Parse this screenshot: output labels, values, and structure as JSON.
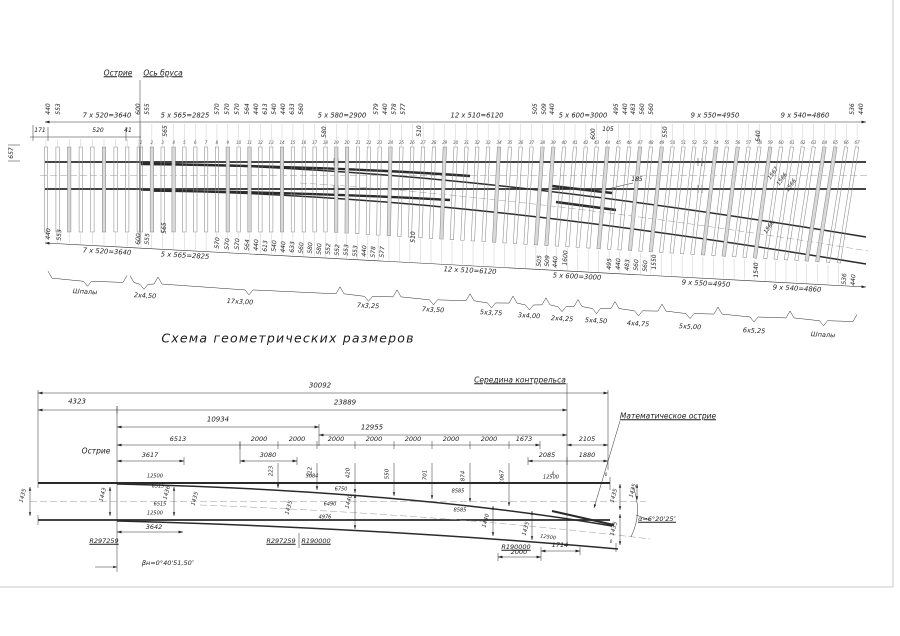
{
  "title": "Схема геометрических размеров",
  "top_diagram": {
    "sleeper_numbers": {
      "from": 1,
      "to": 67
    },
    "labels": [
      {
        "t": "Острие",
        "x": 118,
        "y": 73,
        "s": 7.5,
        "u": 1
      },
      {
        "t": "Ось бруса",
        "x": 163,
        "y": 73,
        "s": 7.5,
        "u": 1
      },
      {
        "t": "657",
        "x": 12,
        "y": 153,
        "r": -90,
        "s": 6
      },
      {
        "t": "440",
        "x": 49,
        "y": 109,
        "r": -90,
        "s": 6
      },
      {
        "t": "553",
        "x": 59,
        "y": 109,
        "r": -90,
        "s": 6
      },
      {
        "t": "600",
        "x": 139,
        "y": 109,
        "r": -90,
        "s": 6
      },
      {
        "t": "555",
        "x": 148,
        "y": 109,
        "r": -90,
        "s": 6
      },
      {
        "t": "570",
        "x": 218,
        "y": 109,
        "r": -90,
        "s": 6
      },
      {
        "t": "570",
        "x": 228,
        "y": 109,
        "r": -90,
        "s": 6
      },
      {
        "t": "570",
        "x": 238,
        "y": 109,
        "r": -90,
        "s": 6
      },
      {
        "t": "564",
        "x": 248,
        "y": 109,
        "r": -90,
        "s": 6
      },
      {
        "t": "440",
        "x": 257,
        "y": 109,
        "r": -90,
        "s": 6
      },
      {
        "t": "613",
        "x": 266,
        "y": 109,
        "r": -90,
        "s": 6
      },
      {
        "t": "540",
        "x": 275,
        "y": 109,
        "r": -90,
        "s": 6
      },
      {
        "t": "440",
        "x": 284,
        "y": 109,
        "r": -90,
        "s": 6
      },
      {
        "t": "633",
        "x": 293,
        "y": 109,
        "r": -90,
        "s": 6
      },
      {
        "t": "560",
        "x": 302,
        "y": 109,
        "r": -90,
        "s": 6
      },
      {
        "t": "579",
        "x": 377,
        "y": 109,
        "r": -90,
        "s": 6
      },
      {
        "t": "440",
        "x": 386,
        "y": 109,
        "r": -90,
        "s": 6
      },
      {
        "t": "578",
        "x": 395,
        "y": 109,
        "r": -90,
        "s": 6
      },
      {
        "t": "577",
        "x": 404,
        "y": 109,
        "r": -90,
        "s": 6
      },
      {
        "t": "505",
        "x": 536,
        "y": 109,
        "r": -90,
        "s": 6
      },
      {
        "t": "509",
        "x": 545,
        "y": 109,
        "r": -90,
        "s": 6
      },
      {
        "t": "440",
        "x": 553,
        "y": 109,
        "r": -90,
        "s": 6
      },
      {
        "t": "495",
        "x": 617,
        "y": 109,
        "r": -90,
        "s": 6
      },
      {
        "t": "440",
        "x": 626,
        "y": 109,
        "r": -90,
        "s": 6
      },
      {
        "t": "483",
        "x": 634,
        "y": 109,
        "r": -90,
        "s": 6
      },
      {
        "t": "560",
        "x": 643,
        "y": 109,
        "r": -90,
        "s": 6
      },
      {
        "t": "560",
        "x": 652,
        "y": 109,
        "r": -90,
        "s": 6
      },
      {
        "t": "536",
        "x": 853,
        "y": 109,
        "r": -90,
        "s": 6
      },
      {
        "t": "440",
        "x": 862,
        "y": 109,
        "r": -90,
        "s": 6
      },
      {
        "t": "7 x 520=3640",
        "x": 107,
        "y": 116,
        "s": 6.8
      },
      {
        "t": "5 x 565=2825",
        "x": 185,
        "y": 116,
        "s": 6.8
      },
      {
        "t": "5 x 580=2900",
        "x": 342,
        "y": 116,
        "s": 6.8
      },
      {
        "t": "12 x 510=6120",
        "x": 477,
        "y": 116,
        "s": 6.8
      },
      {
        "t": "5 x 600=3000",
        "x": 583,
        "y": 116,
        "s": 6.8
      },
      {
        "t": "9 x 550=4950",
        "x": 715,
        "y": 116,
        "s": 6.8
      },
      {
        "t": "9 x 540=4860",
        "x": 805,
        "y": 116,
        "s": 6.8
      },
      {
        "t": "171",
        "x": 40,
        "y": 131,
        "s": 6
      },
      {
        "t": "520",
        "x": 98,
        "y": 131,
        "s": 6
      },
      {
        "t": "41",
        "x": 128,
        "y": 131,
        "s": 6
      },
      {
        "t": "565",
        "x": 166,
        "y": 131,
        "r": -90,
        "s": 6
      },
      {
        "t": "580",
        "x": 325,
        "y": 132,
        "r": -90,
        "s": 6
      },
      {
        "t": "510",
        "x": 420,
        "y": 131,
        "r": -90,
        "s": 6
      },
      {
        "t": "600",
        "x": 594,
        "y": 134,
        "r": -90,
        "s": 6
      },
      {
        "t": "105",
        "x": 608,
        "y": 130,
        "s": 6
      },
      {
        "t": "550",
        "x": 666,
        "y": 132,
        "r": -90,
        "s": 6
      },
      {
        "t": "540",
        "x": 759,
        "y": 136,
        "r": -90,
        "s": 6
      },
      {
        "t": "185",
        "x": 637,
        "y": 180,
        "s": 6
      },
      {
        "t": "1567",
        "x": 774,
        "y": 174,
        "r": -55,
        "s": 5.5
      },
      {
        "t": "1566",
        "x": 783,
        "y": 180,
        "r": -55,
        "s": 5.5
      },
      {
        "t": "1566",
        "x": 792,
        "y": 186,
        "r": -55,
        "s": 5.5
      },
      {
        "t": "1566",
        "x": 770,
        "y": 228,
        "r": -55,
        "s": 5.5
      },
      {
        "t": "440",
        "x": 49,
        "y": 234,
        "r": -87,
        "s": 6
      },
      {
        "t": "553",
        "x": 60,
        "y": 235,
        "r": -87,
        "s": 6
      },
      {
        "t": "600",
        "x": 139,
        "y": 239,
        "r": -87,
        "s": 6
      },
      {
        "t": "555",
        "x": 148,
        "y": 239,
        "r": -87,
        "s": 6
      },
      {
        "t": "565",
        "x": 165,
        "y": 228,
        "r": -90,
        "s": 6
      },
      {
        "t": "570",
        "x": 218,
        "y": 243,
        "r": -87,
        "s": 6
      },
      {
        "t": "570",
        "x": 228,
        "y": 244,
        "r": -87,
        "s": 6
      },
      {
        "t": "570",
        "x": 238,
        "y": 244,
        "r": -87,
        "s": 6
      },
      {
        "t": "564",
        "x": 248,
        "y": 245,
        "r": -87,
        "s": 6
      },
      {
        "t": "440",
        "x": 257,
        "y": 245,
        "r": -87,
        "s": 6
      },
      {
        "t": "613",
        "x": 266,
        "y": 246,
        "r": -87,
        "s": 6
      },
      {
        "t": "540",
        "x": 275,
        "y": 246,
        "r": -87,
        "s": 6
      },
      {
        "t": "440",
        "x": 284,
        "y": 247,
        "r": -87,
        "s": 6
      },
      {
        "t": "633",
        "x": 293,
        "y": 247,
        "r": -87,
        "s": 6
      },
      {
        "t": "560",
        "x": 302,
        "y": 248,
        "r": -87,
        "s": 6
      },
      {
        "t": "580",
        "x": 311,
        "y": 248,
        "r": -87,
        "s": 6
      },
      {
        "t": "580",
        "x": 320,
        "y": 249,
        "r": -87,
        "s": 6
      },
      {
        "t": "552",
        "x": 329,
        "y": 249,
        "r": -87,
        "s": 6
      },
      {
        "t": "552",
        "x": 338,
        "y": 250,
        "r": -87,
        "s": 6
      },
      {
        "t": "553",
        "x": 347,
        "y": 250,
        "r": -87,
        "s": 6
      },
      {
        "t": "553",
        "x": 356,
        "y": 251,
        "r": -87,
        "s": 6
      },
      {
        "t": "440",
        "x": 365,
        "y": 251,
        "r": -87,
        "s": 6
      },
      {
        "t": "578",
        "x": 374,
        "y": 252,
        "r": -87,
        "s": 6
      },
      {
        "t": "577",
        "x": 383,
        "y": 252,
        "r": -87,
        "s": 6
      },
      {
        "t": "510",
        "x": 414,
        "y": 237,
        "r": -90,
        "s": 6
      },
      {
        "t": "505",
        "x": 540,
        "y": 261,
        "r": -87,
        "s": 6
      },
      {
        "t": "509",
        "x": 548,
        "y": 261,
        "r": -87,
        "s": 6
      },
      {
        "t": "440",
        "x": 556,
        "y": 262,
        "r": -87,
        "s": 6
      },
      {
        "t": "1600",
        "x": 566,
        "y": 258,
        "r": -87,
        "s": 6
      },
      {
        "t": "495",
        "x": 610,
        "y": 264,
        "r": -87,
        "s": 6
      },
      {
        "t": "440",
        "x": 619,
        "y": 264,
        "r": -87,
        "s": 6
      },
      {
        "t": "483",
        "x": 628,
        "y": 265,
        "r": -87,
        "s": 6
      },
      {
        "t": "560",
        "x": 637,
        "y": 265,
        "r": -87,
        "s": 6
      },
      {
        "t": "560",
        "x": 646,
        "y": 266,
        "r": -87,
        "s": 6
      },
      {
        "t": "1550",
        "x": 655,
        "y": 262,
        "r": -90,
        "s": 6
      },
      {
        "t": "1540",
        "x": 757,
        "y": 270,
        "r": -90,
        "s": 6
      },
      {
        "t": "536",
        "x": 845,
        "y": 279,
        "r": -87,
        "s": 6
      },
      {
        "t": "440",
        "x": 854,
        "y": 280,
        "r": -87,
        "s": 6
      },
      {
        "t": "7 x 520=3640",
        "x": 107,
        "y": 252,
        "r": 3,
        "s": 6.8
      },
      {
        "t": "5 x 565=2825",
        "x": 185,
        "y": 256,
        "r": 3,
        "s": 6.8
      },
      {
        "t": "12 x 510=6120",
        "x": 470,
        "y": 271,
        "r": 3,
        "s": 6.8
      },
      {
        "t": "5 x 600=3000",
        "x": 577,
        "y": 277,
        "r": 3,
        "s": 6.8
      },
      {
        "t": "9 x 550=4950",
        "x": 706,
        "y": 284,
        "r": 3,
        "s": 6.8
      },
      {
        "t": "9 x 540=4860",
        "x": 797,
        "y": 289,
        "r": 3,
        "s": 6.8
      }
    ],
    "braces": [
      {
        "t": "Шпалы",
        "x1": 48,
        "x2": 127,
        "lx": 85,
        "ly": 292
      },
      {
        "t": "2x4,50",
        "x1": 130,
        "x2": 158,
        "lx": 145,
        "ly": 296
      },
      {
        "t": "17x3,00",
        "x1": 158,
        "x2": 340,
        "lx": 240,
        "ly": 302
      },
      {
        "t": "7x3,25",
        "x1": 340,
        "x2": 397,
        "lx": 368,
        "ly": 306
      },
      {
        "t": "7x3,50",
        "x1": 397,
        "x2": 470,
        "lx": 433,
        "ly": 310
      },
      {
        "t": "5x3,75",
        "x1": 470,
        "x2": 513,
        "lx": 491,
        "ly": 313
      },
      {
        "t": "3x4,00",
        "x1": 513,
        "x2": 546,
        "lx": 529,
        "ly": 316
      },
      {
        "t": "2x4,25",
        "x1": 546,
        "x2": 578,
        "lx": 562,
        "ly": 319
      },
      {
        "t": "5x4,50",
        "x1": 578,
        "x2": 615,
        "lx": 596,
        "ly": 321
      },
      {
        "t": "4x4,75",
        "x1": 615,
        "x2": 662,
        "lx": 638,
        "ly": 324
      },
      {
        "t": "5x5,00",
        "x1": 662,
        "x2": 718,
        "lx": 690,
        "ly": 327
      },
      {
        "t": "6x5,25",
        "x1": 718,
        "x2": 790,
        "lx": 754,
        "ly": 331
      },
      {
        "t": "Шпалы",
        "x1": 790,
        "x2": 857,
        "lx": 823,
        "ly": 335
      }
    ]
  },
  "bottom_diagram": {
    "labels": [
      {
        "t": "Середина контррельса",
        "x": 520,
        "y": 380,
        "s": 7.5,
        "u": 1
      },
      {
        "t": "Математическое острие",
        "x": 668,
        "y": 416,
        "s": 7.5,
        "u": 1
      },
      {
        "t": "Острие",
        "x": 96,
        "y": 451,
        "s": 7.5
      },
      {
        "t": "30092",
        "x": 320,
        "y": 386,
        "s": 7
      },
      {
        "t": "4323",
        "x": 77,
        "y": 402,
        "s": 7
      },
      {
        "t": "23889",
        "x": 345,
        "y": 403,
        "s": 7
      },
      {
        "t": "10934",
        "x": 218,
        "y": 420,
        "s": 7
      },
      {
        "t": "12955",
        "x": 372,
        "y": 428,
        "s": 7
      },
      {
        "t": "6513",
        "x": 178,
        "y": 439,
        "s": 6.5
      },
      {
        "t": "2000",
        "x": 259,
        "y": 439,
        "s": 6.5
      },
      {
        "t": "2000",
        "x": 297,
        "y": 439,
        "s": 6.5
      },
      {
        "t": "2000",
        "x": 336,
        "y": 439,
        "s": 6.5
      },
      {
        "t": "2000",
        "x": 374,
        "y": 439,
        "s": 6.5
      },
      {
        "t": "2000",
        "x": 413,
        "y": 439,
        "s": 6.5
      },
      {
        "t": "2000",
        "x": 451,
        "y": 439,
        "s": 6.5
      },
      {
        "t": "2000",
        "x": 489,
        "y": 439,
        "s": 6.5
      },
      {
        "t": "1673",
        "x": 524,
        "y": 439,
        "s": 6.5
      },
      {
        "t": "2105",
        "x": 587,
        "y": 439,
        "s": 6.5
      },
      {
        "t": "3617",
        "x": 150,
        "y": 455,
        "s": 6.5
      },
      {
        "t": "3080",
        "x": 268,
        "y": 455,
        "s": 6.5
      },
      {
        "t": "2085",
        "x": 547,
        "y": 455,
        "s": 6.5
      },
      {
        "t": "1880",
        "x": 587,
        "y": 455,
        "s": 6.5
      },
      {
        "t": "223",
        "x": 272,
        "y": 471,
        "r": -90,
        "s": 5.5
      },
      {
        "t": "312",
        "x": 311,
        "y": 472,
        "r": -90,
        "s": 5.5
      },
      {
        "t": "420",
        "x": 349,
        "y": 473,
        "r": -90,
        "s": 5.5
      },
      {
        "t": "550",
        "x": 388,
        "y": 474,
        "r": -90,
        "s": 5.5
      },
      {
        "t": "701",
        "x": 426,
        "y": 475,
        "r": -90,
        "s": 5.5
      },
      {
        "t": "874",
        "x": 464,
        "y": 476,
        "r": -90,
        "s": 5.5
      },
      {
        "t": "1067",
        "x": 503,
        "y": 477,
        "r": -90,
        "s": 5.5
      },
      {
        "t": "12500",
        "x": 155,
        "y": 477,
        "s": 5
      },
      {
        "t": "6515",
        "x": 158,
        "y": 487,
        "s": 5
      },
      {
        "t": "6515",
        "x": 160,
        "y": 505,
        "s": 5
      },
      {
        "t": "12500",
        "x": 155,
        "y": 514,
        "s": 5
      },
      {
        "t": "5084",
        "x": 312,
        "y": 477,
        "s": 5
      },
      {
        "t": "6750",
        "x": 341,
        "y": 490,
        "s": 5
      },
      {
        "t": "6490",
        "x": 330,
        "y": 505,
        "s": 5
      },
      {
        "t": "4976",
        "x": 325,
        "y": 518,
        "s": 5
      },
      {
        "t": "8585",
        "x": 458,
        "y": 492,
        "s": 5
      },
      {
        "t": "8585",
        "x": 460,
        "y": 511,
        "s": 5
      },
      {
        "t": "12500",
        "x": 551,
        "y": 478,
        "s": 5
      },
      {
        "t": "12500",
        "x": 548,
        "y": 538,
        "r": 8,
        "s": 5
      },
      {
        "t": "0",
        "x": 553,
        "y": 474,
        "s": 4
      },
      {
        "t": "0",
        "x": 606,
        "y": 475,
        "s": 4
      },
      {
        "t": "0",
        "x": 611,
        "y": 542,
        "s": 4
      },
      {
        "t": "1435",
        "x": 24,
        "y": 496,
        "r": -75,
        "s": 5.5
      },
      {
        "t": "1443",
        "x": 104,
        "y": 495,
        "r": -75,
        "s": 5.5
      },
      {
        "t": "1436",
        "x": 168,
        "y": 493,
        "r": -75,
        "s": 5.5
      },
      {
        "t": "1435",
        "x": 196,
        "y": 499,
        "r": -75,
        "s": 5.5
      },
      {
        "t": "1435",
        "x": 290,
        "y": 508,
        "r": -75,
        "s": 5.5
      },
      {
        "t": "1440",
        "x": 350,
        "y": 502,
        "r": -75,
        "s": 5.5
      },
      {
        "t": "1440",
        "x": 487,
        "y": 521,
        "r": -75,
        "s": 5.5
      },
      {
        "t": "1435",
        "x": 527,
        "y": 529,
        "r": -75,
        "s": 5.5
      },
      {
        "t": "1435",
        "x": 615,
        "y": 496,
        "r": -75,
        "s": 5.5
      },
      {
        "t": "1435",
        "x": 615,
        "y": 529,
        "r": -75,
        "s": 5.5
      },
      {
        "t": "1435",
        "x": 634,
        "y": 491,
        "r": -75,
        "s": 5.5
      },
      {
        "t": "R297259",
        "x": 104,
        "y": 541,
        "s": 6.5,
        "u": 1
      },
      {
        "t": "R297259",
        "x": 281,
        "y": 541,
        "s": 6.5,
        "u": 1
      },
      {
        "t": "R190000",
        "x": 316,
        "y": 541,
        "s": 6.5,
        "u": 1
      },
      {
        "t": "R190000",
        "x": 516,
        "y": 547,
        "s": 6.5,
        "u": 1
      },
      {
        "t": "1714",
        "x": 560,
        "y": 545,
        "s": 6.5
      },
      {
        "t": "2000",
        "x": 519,
        "y": 552,
        "s": 6.5
      },
      {
        "t": "3642",
        "x": 154,
        "y": 527,
        "s": 6.5
      },
      {
        "t": "βн=0°40'51,50″",
        "x": 168,
        "y": 563,
        "s": 6.5
      },
      {
        "t": "α=6°20'25″",
        "x": 657,
        "y": 519,
        "s": 6.5,
        "u": 1
      }
    ]
  }
}
